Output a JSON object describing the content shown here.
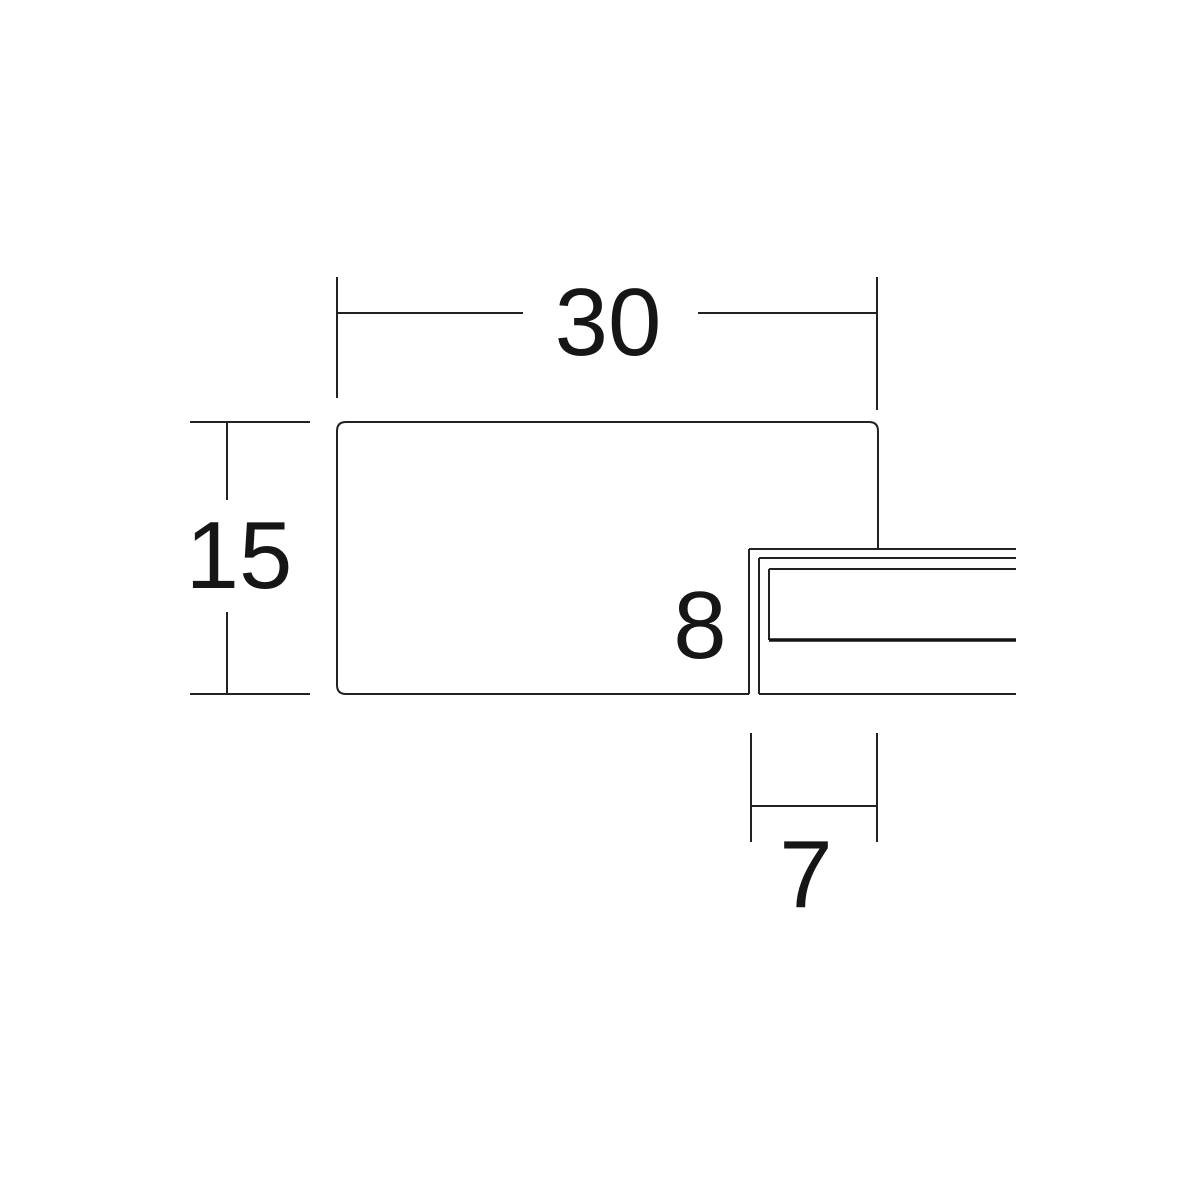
{
  "page": {
    "background_color": "#ffffff",
    "line_color": "#222222",
    "text_color": "#161616"
  },
  "diagram": {
    "kind": "moulding-profile-cross-section",
    "dimensions": {
      "overall_width": {
        "label": "30"
      },
      "overall_height": {
        "label": "15"
      },
      "rabbet_height": {
        "label": "8"
      },
      "rabbet_depth": {
        "label": "7"
      }
    }
  }
}
